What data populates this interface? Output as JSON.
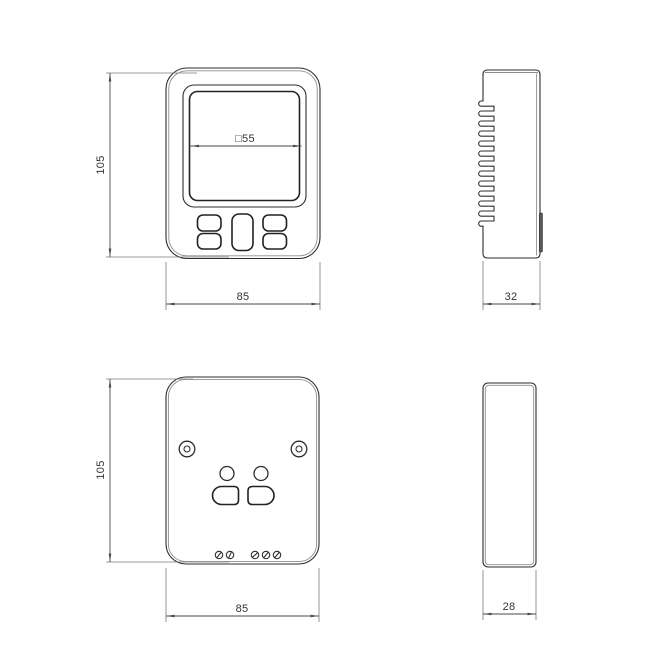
{
  "drawing": {
    "type": "technical-drawing",
    "subject": "wall-mounted thermostat enclosure, four orthographic views"
  },
  "views": {
    "front": {
      "height_label": "105",
      "width_label": "85",
      "screen_label": "□55"
    },
    "right_side": {
      "depth_label": "32"
    },
    "back": {
      "height_label": "105",
      "width_label": "85"
    },
    "back_side": {
      "depth_label": "28"
    }
  },
  "colors": {
    "background": "#ffffff",
    "line": "#2e2e2e",
    "secondary_line": "#8d8d8d",
    "dimension_line": "#4a4a4a",
    "text": "#333333"
  }
}
